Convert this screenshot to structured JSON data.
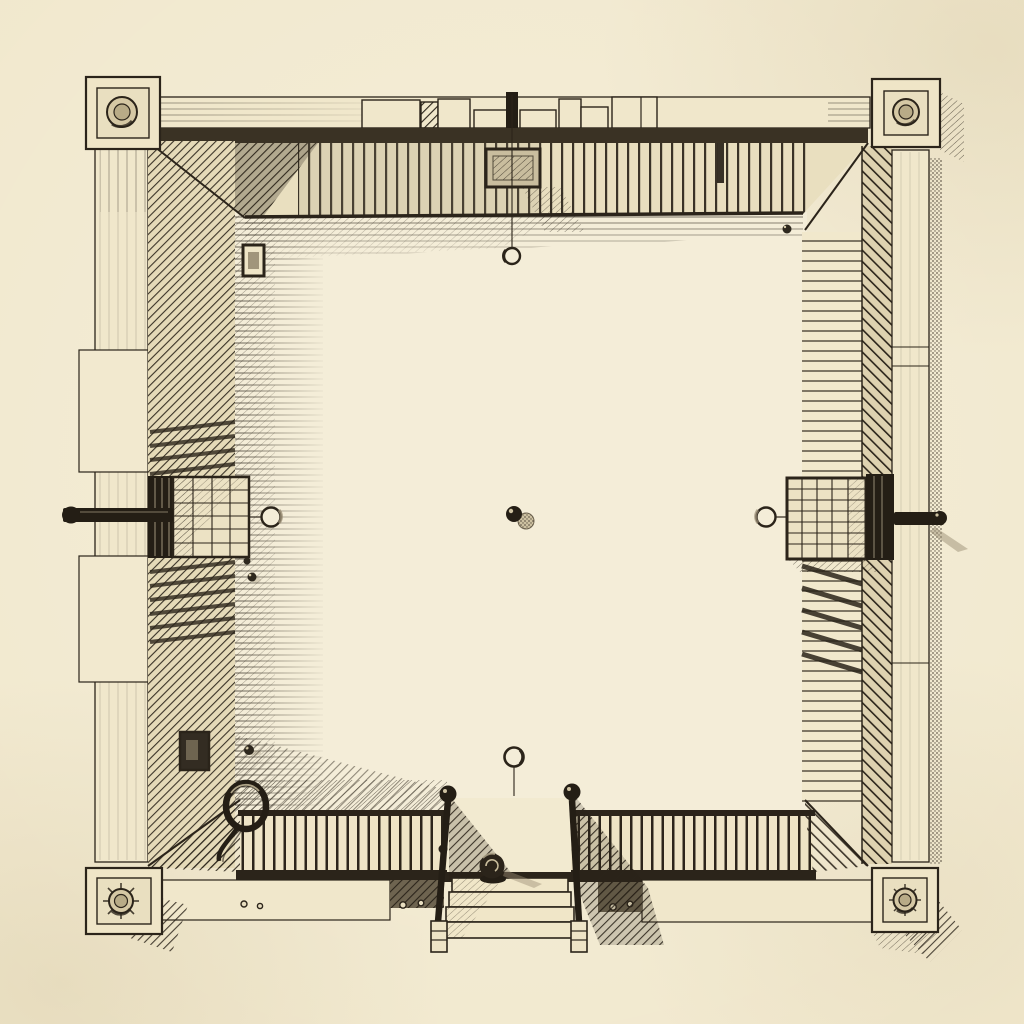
{
  "image": {
    "kind": "pen-and-ink architectural plan drawing on aged paper",
    "subject": "square walled court (troco/game court) seen from above in slight bird's-eye perspective",
    "text_content": "none — the drawing contains no written labels or numbers"
  },
  "colors": {
    "paper": "#f1e8cd",
    "paperLight": "#f4edd8",
    "bandLight": "#f0e7cb",
    "wallLight": "#e9dfbf",
    "gridLight": "#ece2c4",
    "ink": "#2b241a",
    "inkDark": "#241e15",
    "shadow": "#9b8f76",
    "boss": "#d5c8a4"
  },
  "scene": {
    "corner_posts": {
      "count": 4,
      "description": "square caps with round dome bosses; lower two bosses have rosette rings; shadows cast to lower-right"
    },
    "walls": {
      "top": "parapet beam with stacked blocks and a small hatch box at center; inner face of vertical balusters, left end in shadow",
      "left": "outer light rail, inner face densely cross-hatched with ladder rungs; small framed plaque and a dark plaque",
      "right": "inner face of horizontal slats, chevron-hatched mid band, light outer rail with stippled edge",
      "bottom": "baluster railing with central opening to a staircase; light outer band with bolt heads"
    },
    "gates": {
      "left": "grid platform inside wall with peg protruding outward and a small ring marker in the court",
      "right": "mirrored grid platform with peg and ring marker"
    },
    "staircase": {
      "steps": 4,
      "newel_posts": 2,
      "finials": "ball finials with banded ferrules at base",
      "object_on_landing": "small dark spiral (snail-like) object"
    },
    "court_markers": [
      "plumb line and ball below top-center hatch box",
      "pair of balls at exact center (one dark, one stippled)",
      "ball with line above the stair opening",
      "small ball near top-right corner",
      "pebbles along the left side",
      "large rope ring with curved tail at bottom-left"
    ]
  }
}
